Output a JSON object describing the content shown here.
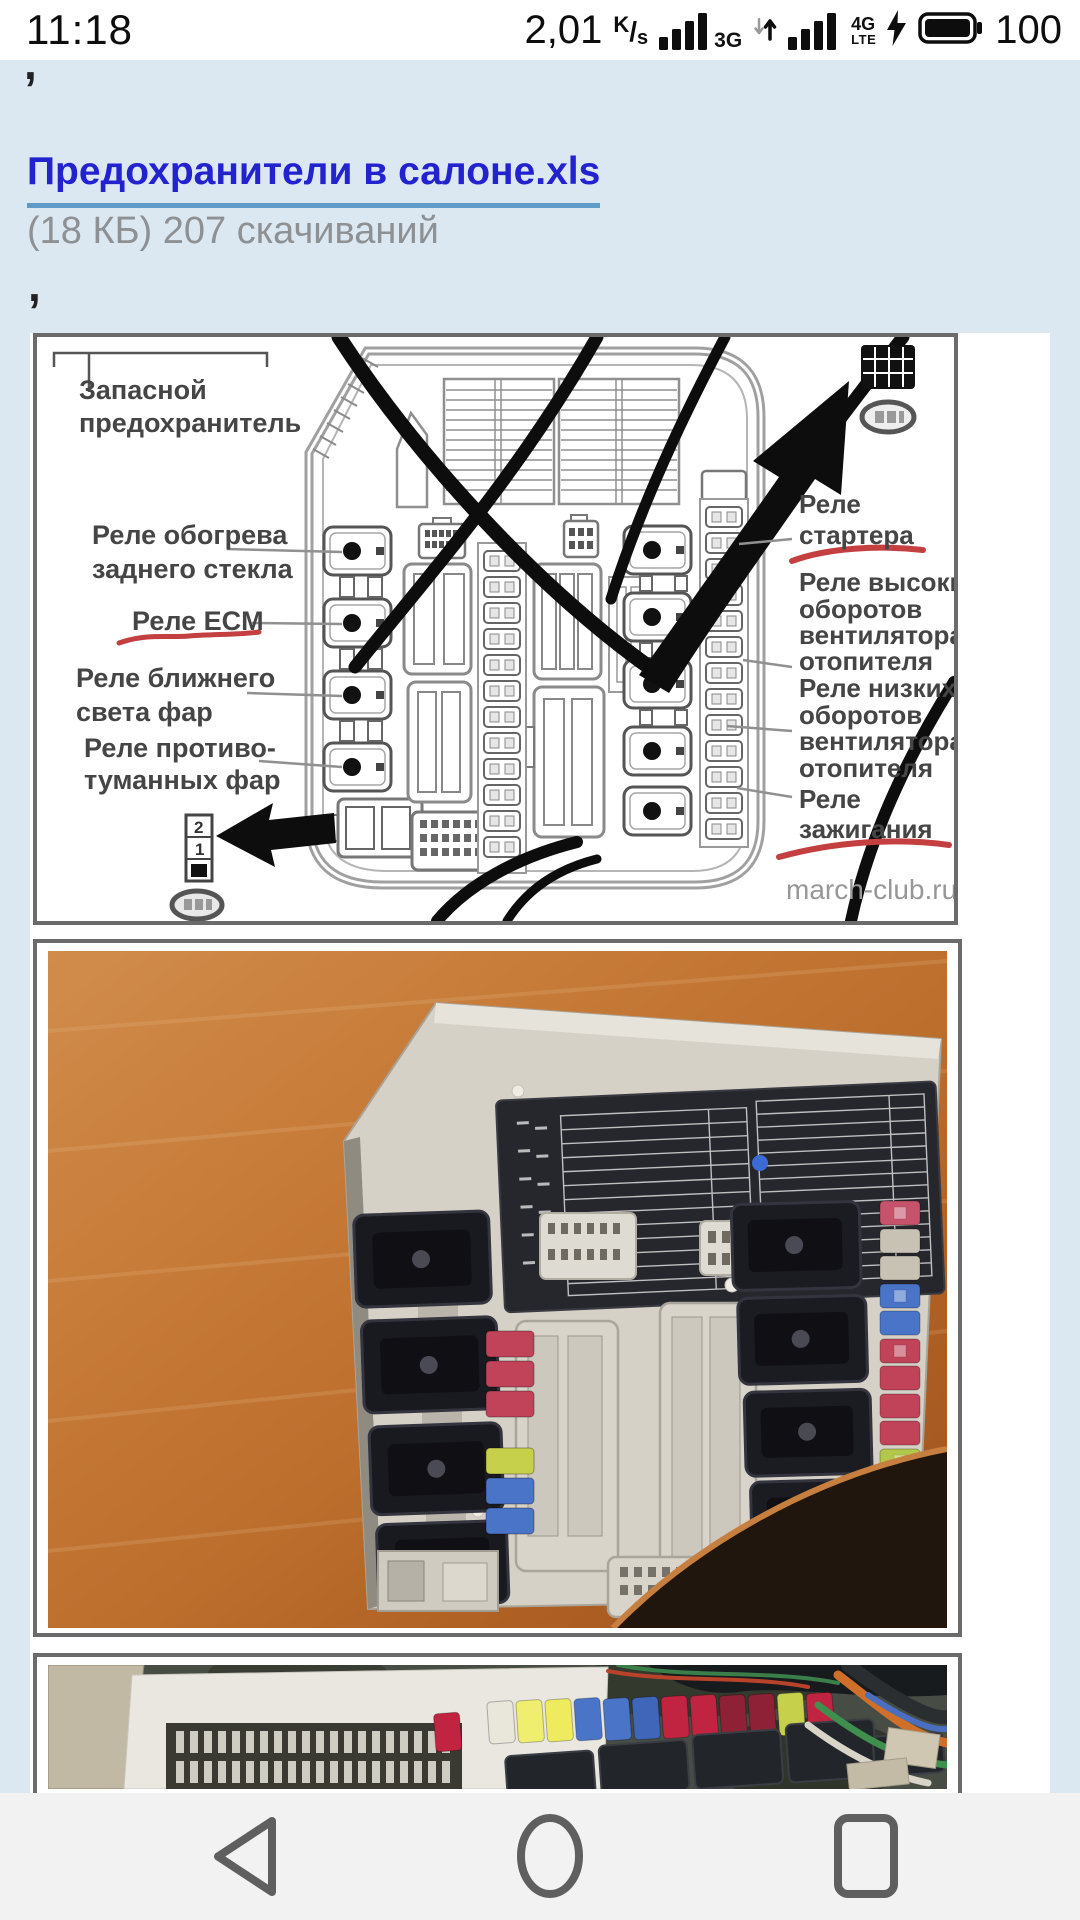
{
  "status_bar": {
    "time": "11:18",
    "network_speed_value": "2,01",
    "network_speed_unit_numerator": "K",
    "network_speed_unit_divider": "/",
    "network_speed_unit_denominator": "s",
    "sim1_network_type": "3G",
    "sim2_network_type_line1": "4G",
    "sim2_network_type_line2": "LTE",
    "battery_level": "100"
  },
  "page": {
    "background_color": "#dbe7f1",
    "comma_top": ",",
    "comma_bottom": ","
  },
  "attachment": {
    "filename_link": "Предохранители в салоне.xls",
    "meta": "(18 КБ) 207 скачиваний",
    "link_color": "#2222cf",
    "underline_color": "#5f9bc9"
  },
  "fuse_diagram": {
    "watermark": "march-club.ru",
    "marker_color": "#c43f3f",
    "labels": {
      "spare_fuse_line1": "Запасной",
      "spare_fuse_line2": "предохранитель",
      "rear_window_relay_line1": "Реле обогрева",
      "rear_window_relay_line2": "заднего стекла",
      "ecm_relay": "Реле ECM",
      "low_beam_relay_line1": "Реле ближнего",
      "low_beam_relay_line2": "света фар",
      "fog_lamp_relay_line1": "Реле противо-",
      "fog_lamp_relay_line2": "туманных фар",
      "starter_relay_line1": "Реле",
      "starter_relay_line2": "стартера",
      "heater_fan_high_line1": "Реле высоких",
      "heater_fan_high_line2": "оборотов",
      "heater_fan_high_line3": "вентилятора",
      "heater_fan_high_line4": "отопителя",
      "heater_fan_low_line1": "Реле низких",
      "heater_fan_low_line2": "оборотов",
      "heater_fan_low_line3": "вентилятора",
      "heater_fan_low_line4": "отопителя",
      "ignition_relay_line1": "Реле",
      "ignition_relay_line2": "зажигания",
      "connector_pin_2": "2",
      "connector_pin_1": "1"
    }
  },
  "navigation_bar": {
    "background_color": "#f2f2f2"
  }
}
